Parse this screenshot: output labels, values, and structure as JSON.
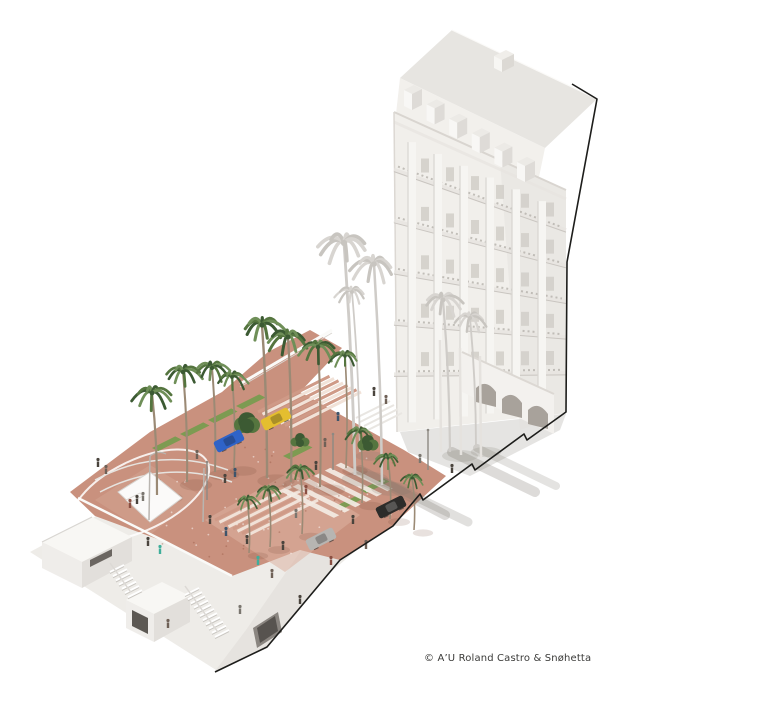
{
  "caption": "© A’U Roland Castro & Snøhetta",
  "scene": {
    "description": "Axonometric rendering: white classical hotel, terracotta esplanade with palms, beach pavilions below",
    "colors": {
      "bg": "#ffffff",
      "outline": "#1d1d1b",
      "plaza": "#c9917e",
      "plaza_light": "#dcb3a1",
      "plaza_light2": "#d8ab98",
      "step_dark": "#cf9a87",
      "step_light": "#f1e2d8",
      "grass": "#7d9b52",
      "trunk": "#9b8a75",
      "palm_dark": "#3c5a33",
      "palm_mid": "#55753f",
      "palm_light": "#6f8f58",
      "palm_white1": "#d8d5d1",
      "palm_white2": "#c8c5c0",
      "palm_white_trunk": "#cfccc8",
      "roof": "#e7e5e1",
      "mansard": "#f2f0ec",
      "facade": "#f1efeb",
      "facade_shade": "#e3e0db",
      "window": "#d3cfca",
      "detail": "#b6b2ac",
      "cornice": "#d9d5d0",
      "portico": "#f3f1ee",
      "arch": "#a8a29b",
      "beach": "#eeece8",
      "slab_face": "#e6e3df",
      "tunnel": "#8a8580",
      "tunnel_dark": "#57534f",
      "pavilion_top": "#f8f7f4",
      "pavilion_front": "#efedea",
      "pavilion_side": "#e2dfdb",
      "opening": "#5d5954",
      "rail": "#fafaf8",
      "car_blue": "#2f63c8",
      "car_yellow": "#e4be2f",
      "car_silver": "#b7b5b2",
      "car_black": "#2d2c2a"
    },
    "building": {
      "floors": 5,
      "bays": 6,
      "dormers": 6
    },
    "outline_path": "M572,84 L597,99 L567,262 L566,412 L527,440 L524,434 L475,470 L472,464 L423,500 L420,494 L393,526 L340,560 L267,647 L215,672",
    "palms_green": [
      [
        152,
        393,
        20,
        157,
        495
      ],
      [
        183,
        372,
        19,
        187,
        482
      ],
      [
        212,
        368,
        18,
        215,
        472
      ],
      [
        232,
        377,
        16,
        234,
        468
      ],
      [
        262,
        325,
        22,
        267,
        478
      ],
      [
        288,
        337,
        21,
        291,
        482
      ],
      [
        318,
        347,
        19,
        320,
        487
      ],
      [
        345,
        356,
        15,
        346,
        468
      ],
      [
        300,
        470,
        14,
        302,
        534
      ],
      [
        268,
        490,
        13,
        270,
        547
      ],
      [
        360,
        432,
        14,
        362,
        503
      ],
      [
        388,
        458,
        13,
        390,
        519
      ],
      [
        247,
        500,
        12,
        249,
        553
      ],
      [
        412,
        478,
        12,
        414,
        530
      ]
    ],
    "palms_white": [
      [
        344,
        243,
        26,
        355,
        475
      ],
      [
        374,
        264,
        23,
        382,
        485
      ],
      [
        352,
        292,
        16,
        360,
        452
      ],
      [
        443,
        300,
        20,
        450,
        452
      ],
      [
        470,
        318,
        17,
        476,
        448
      ]
    ],
    "bushes": [
      [
        247,
        423,
        16
      ],
      [
        368,
        443,
        11
      ],
      [
        300,
        440,
        9
      ]
    ],
    "grass_strips": [
      [
        152,
        448
      ],
      [
        180,
        434
      ],
      [
        208,
        420
      ],
      [
        236,
        406
      ],
      [
        283,
        456
      ],
      [
        336,
        506
      ],
      [
        360,
        490
      ]
    ],
    "steps": [
      {
        "x": 215,
        "y": 520,
        "len": 80,
        "count": 8
      },
      {
        "x": 258,
        "y": 412,
        "len": 80,
        "count": 8
      }
    ],
    "crosswalk": {
      "x": 282,
      "y": 492,
      "count": 6
    },
    "stairs": [
      {
        "x": 110,
        "y": 572,
        "count": 7
      },
      {
        "x": 185,
        "y": 595,
        "count": 11
      }
    ],
    "cars": [
      {
        "x": 229,
        "y": 441,
        "color": "car_blue"
      },
      {
        "x": 276,
        "y": 419,
        "color": "car_yellow"
      },
      {
        "x": 321,
        "y": 539,
        "color": "car_silver"
      },
      {
        "x": 391,
        "y": 507,
        "color": "car_black"
      }
    ],
    "people_palette": [
      "#4a443d",
      "#6f6157",
      "#3fae9b",
      "#8a4f42",
      "#3e546b",
      "#7a766f"
    ],
    "people": [
      [
        98,
        464,
        0
      ],
      [
        106,
        471,
        1
      ],
      [
        130,
        505,
        3
      ],
      [
        137,
        501,
        0
      ],
      [
        143,
        498,
        5
      ],
      [
        160,
        551,
        2
      ],
      [
        148,
        543,
        0
      ],
      [
        197,
        456,
        1
      ],
      [
        210,
        521,
        0
      ],
      [
        226,
        533,
        4
      ],
      [
        247,
        541,
        0
      ],
      [
        258,
        562,
        2
      ],
      [
        272,
        575,
        1
      ],
      [
        283,
        547,
        0
      ],
      [
        296,
        515,
        5
      ],
      [
        306,
        491,
        3
      ],
      [
        316,
        467,
        0
      ],
      [
        325,
        444,
        1
      ],
      [
        338,
        418,
        4
      ],
      [
        353,
        521,
        0
      ],
      [
        366,
        546,
        1
      ],
      [
        300,
        601,
        0
      ],
      [
        331,
        562,
        3
      ],
      [
        240,
        611,
        5
      ],
      [
        374,
        393,
        0
      ],
      [
        386,
        401,
        1
      ],
      [
        452,
        470,
        0
      ],
      [
        420,
        460,
        5
      ],
      [
        225,
        480,
        0
      ],
      [
        235,
        474,
        4
      ],
      [
        168,
        625,
        1
      ]
    ],
    "poles": [
      [
        207,
        462,
        38
      ],
      [
        333,
        434,
        36
      ],
      [
        428,
        430,
        40
      ]
    ]
  }
}
